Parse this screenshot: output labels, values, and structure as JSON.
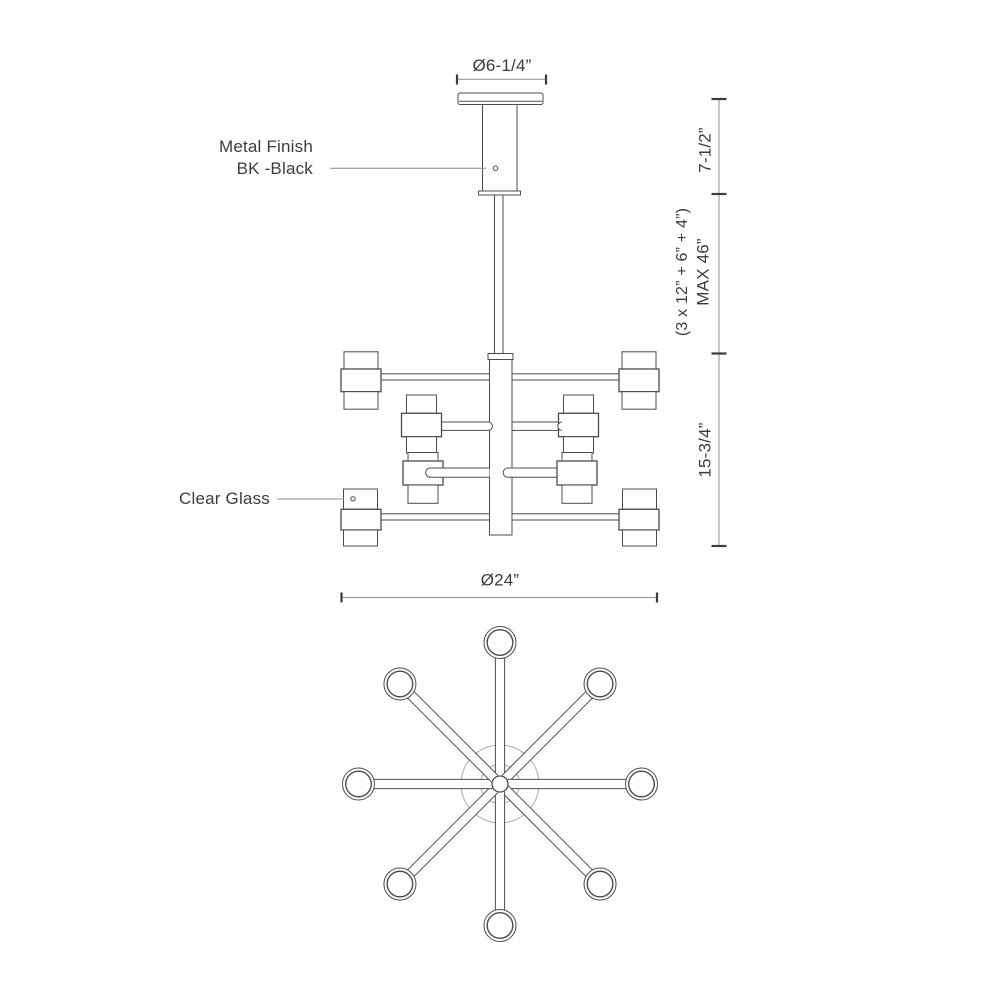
{
  "drawing": {
    "annotations": {
      "metal_finish": {
        "line1": "Metal Finish",
        "line2": "BK -Black"
      },
      "clear_glass": {
        "label": "Clear Glass"
      }
    },
    "dimensions": {
      "canopy_diameter": "Ø6-1/4”",
      "canopy_height": "7-1/2”",
      "suspension_max": "MAX 46”",
      "suspension_breakdown": "(3 x 12” + 6” + 4”)",
      "body_height": "15-3/4”",
      "body_diameter": "Ø24”"
    },
    "colors": {
      "line": "#4c4c4c",
      "dimension": "#8f8f8f",
      "text": "#3c3c3c",
      "hub": "#ababab",
      "background": "#ffffff"
    }
  }
}
